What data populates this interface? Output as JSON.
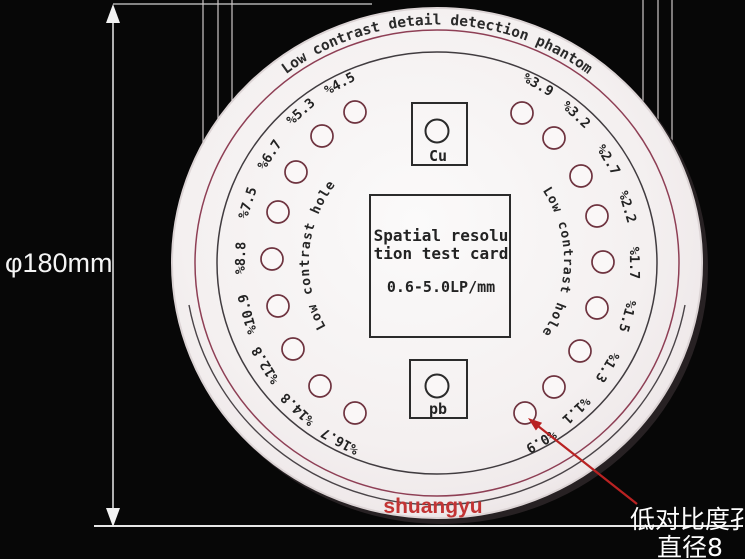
{
  "dimension": {
    "label": "φ180mm"
  },
  "callout": {
    "line1": "低对比度孔",
    "line2": "直径8"
  },
  "watermark": "shuangyu",
  "phantom": {
    "arc_title": "Low contrast detail detection phantom",
    "left_arc_label": "Low contrast hole",
    "right_arc_label": "Low contrast hole",
    "center_card": {
      "line1": "Spatial resolu",
      "line2": "tion test card",
      "line3": "0.6-5.0LP/mm"
    },
    "cu_marker": "Cu",
    "pb_marker": "pb",
    "holes_left": [
      {
        "label": "%4.5",
        "cx": 355,
        "cy": 112,
        "lx": 340,
        "ly": 84,
        "rot": -28.5
      },
      {
        "label": "%5.3",
        "cx": 322,
        "cy": 136,
        "lx": 301,
        "ly": 112,
        "rot": -42
      },
      {
        "label": "%6.7",
        "cx": 296,
        "cy": 172,
        "lx": 270,
        "ly": 155,
        "rot": -57
      },
      {
        "label": "%7.5",
        "cx": 278,
        "cy": 212,
        "lx": 248,
        "ly": 203,
        "rot": -72
      },
      {
        "label": "%8.8",
        "cx": 272,
        "cy": 259,
        "lx": 241,
        "ly": 258,
        "rot": -88.5
      },
      {
        "label": "%10.9",
        "cx": 278,
        "cy": 306,
        "lx": 248,
        "ly": 314,
        "rot": -105
      },
      {
        "label": "%12.8",
        "cx": 293,
        "cy": 349,
        "lx": 266,
        "ly": 365,
        "rot": -121
      },
      {
        "label": "%14.8",
        "cx": 320,
        "cy": 386,
        "lx": 298,
        "ly": 409,
        "rot": -136.5
      },
      {
        "label": "%16.7",
        "cx": 355,
        "cy": 413,
        "lx": 340,
        "ly": 441,
        "rot": -151.5
      }
    ],
    "holes_right": [
      {
        "label": "%3.9",
        "cx": 522,
        "cy": 113,
        "lx": 538,
        "ly": 85,
        "rot": 29.5
      },
      {
        "label": "%3.2",
        "cx": 554,
        "cy": 138,
        "lx": 576,
        "ly": 115,
        "rot": 43
      },
      {
        "label": "%2.7",
        "cx": 581,
        "cy": 176,
        "lx": 608,
        "ly": 160,
        "rot": 59
      },
      {
        "label": "%2.2",
        "cx": 597,
        "cy": 216,
        "lx": 627,
        "ly": 207,
        "rot": 73.5
      },
      {
        "label": "%1.7",
        "cx": 603,
        "cy": 262,
        "lx": 634,
        "ly": 263,
        "rot": 89.5
      },
      {
        "label": "%1.5",
        "cx": 597,
        "cy": 308,
        "lx": 627,
        "ly": 316,
        "rot": 105.5
      },
      {
        "label": "%1.3",
        "cx": 580,
        "cy": 351,
        "lx": 607,
        "ly": 367,
        "rot": 121.5
      },
      {
        "label": "%1.1",
        "cx": 554,
        "cy": 387,
        "lx": 576,
        "ly": 410,
        "rot": 136.5
      },
      {
        "label": "%0.9",
        "cx": 525,
        "cy": 413,
        "lx": 541,
        "ly": 441,
        "rot": 149.5
      }
    ]
  },
  "colors": {
    "background": "#070707",
    "disc_white": "#f7f3f3",
    "ring_maroon": "#8e3f55",
    "ring_dark": "#413c40",
    "hole_ring": "#6e333f",
    "ink": "#232323",
    "watermark_red": "#c23434",
    "arrow_red": "#b92222",
    "annotation_white": "#f4f4f4"
  }
}
